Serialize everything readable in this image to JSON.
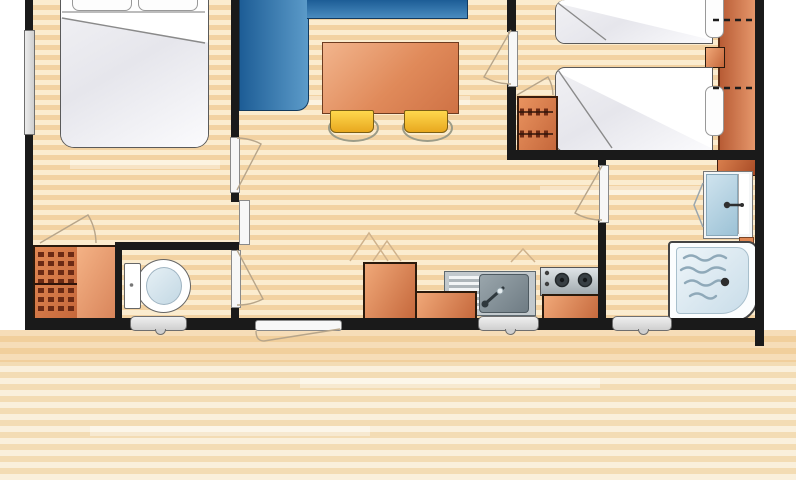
{
  "meta": {
    "kind": "floor-plan",
    "subject": "mobile-home-2-bedroom-floor-plan",
    "visible_text": "none"
  },
  "rooms": [
    {
      "name": "bedroom-double",
      "furniture": [
        "double-bed",
        "wardrobe-with-hangers",
        "side-window"
      ]
    },
    {
      "name": "living-dining",
      "furniture": [
        "corner-sofa",
        "dining-table",
        "stool",
        "stool"
      ]
    },
    {
      "name": "kitchen",
      "furniture": [
        "tall-cabinet-fridge",
        "sink-with-drainer",
        "under-sink-cabinet",
        "two-burner-hob"
      ]
    },
    {
      "name": "wc",
      "furniture": [
        "toilet",
        "window"
      ]
    },
    {
      "name": "bedroom-twin",
      "furniture": [
        "twin-bed",
        "twin-bed",
        "nightstand",
        "wardrobe-strip",
        "dresser-with-hangers"
      ]
    },
    {
      "name": "shower-room",
      "furniture": [
        "washbasin",
        "shower-tray",
        "window"
      ]
    },
    {
      "name": "terrace",
      "furniture": []
    }
  ],
  "doors": [
    {
      "name": "bedroom-double-door"
    },
    {
      "name": "sliding-panel"
    },
    {
      "name": "wc-door"
    },
    {
      "name": "bedroom-twin-door"
    },
    {
      "name": "shower-room-door"
    },
    {
      "name": "entrance-door"
    }
  ],
  "windows": [
    {
      "name": "left-wall-window"
    },
    {
      "name": "wc-window"
    },
    {
      "name": "kitchen-window"
    },
    {
      "name": "shower-room-window"
    }
  ],
  "colors": {
    "wall": "#1a1a1a",
    "floorA": "#fbeccf",
    "floorB": "#f2d2a2",
    "terrA": "#faf0dc",
    "terrB": "#f3dcb4",
    "orA": "#f0a878",
    "orB": "#c4663a",
    "orOut": "#2b1a0c",
    "sofaA": "#1d5d96",
    "sofaB": "#5c9bc9",
    "sofaOut": "#123a5f",
    "yellow": "#f6c62f",
    "yellowOut": "#7c5f15",
    "winFill": "#cfcfcf",
    "winEdge": "#6f6f6f",
    "metalA": "#dfe4e7",
    "metalB": "#9fa8ad",
    "waterA": "#eef5f9",
    "waterB": "#c9dde9",
    "bedOut": "#5a5a5a",
    "lineTan": "#cfb28c"
  }
}
